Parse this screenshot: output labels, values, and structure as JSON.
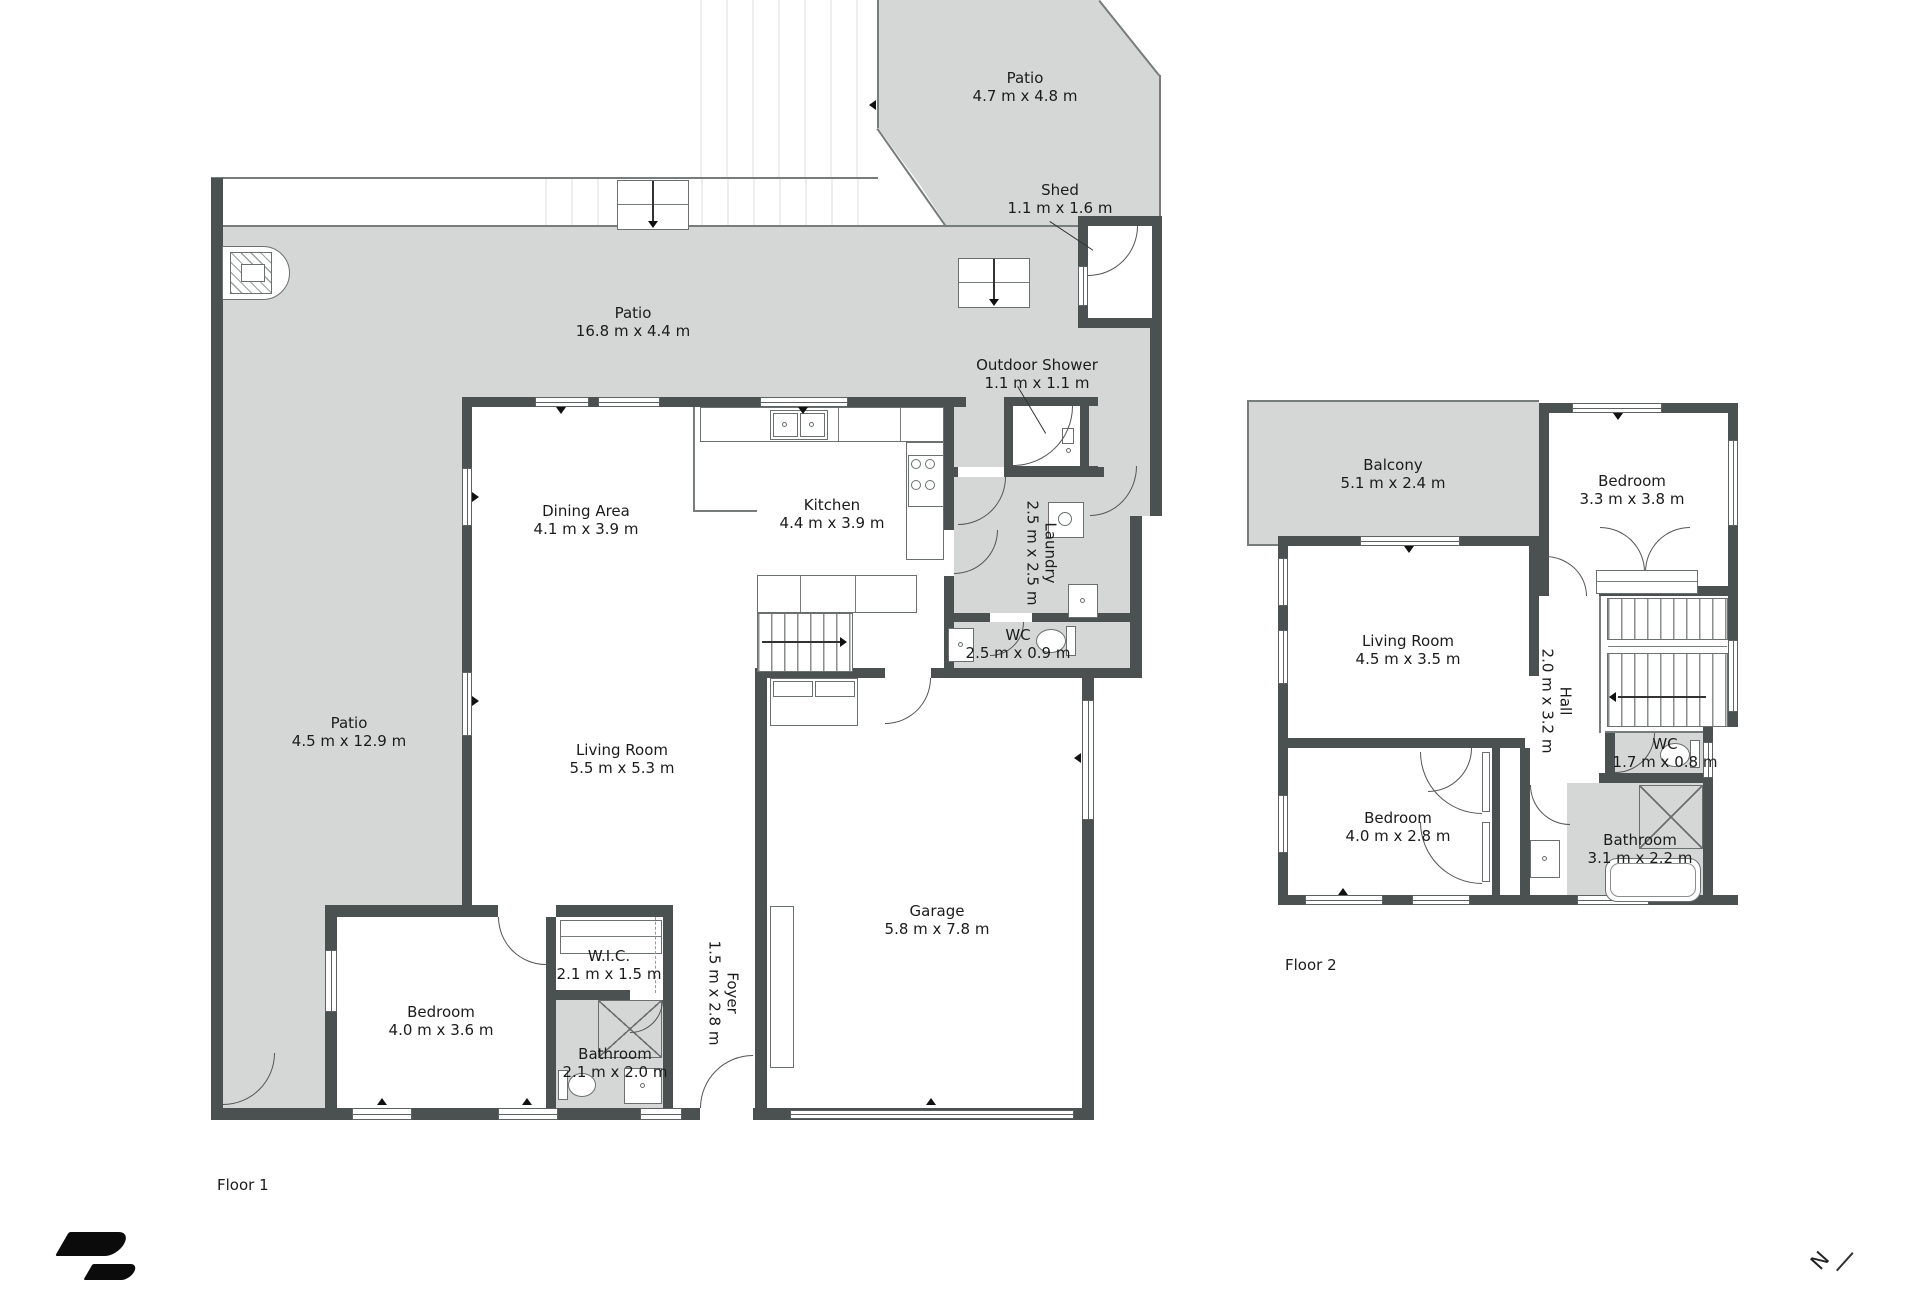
{
  "floors": {
    "floor1": {
      "label": "Floor 1",
      "rooms": {
        "patio_top": {
          "name": "Patio",
          "dims": "4.7 m x 4.8 m"
        },
        "shed": {
          "name": "Shed",
          "dims": "1.1 m x 1.6 m"
        },
        "patio_main": {
          "name": "Patio",
          "dims": "16.8 m x 4.4 m"
        },
        "outdoor_shower": {
          "name": "Outdoor Shower",
          "dims": "1.1 m x 1.1 m"
        },
        "dining": {
          "name": "Dining Area",
          "dims": "4.1 m x 3.9 m"
        },
        "kitchen": {
          "name": "Kitchen",
          "dims": "4.4 m x 3.9 m"
        },
        "laundry": {
          "name": "Laundry",
          "dims": "2.5 m x 2.5 m"
        },
        "wc": {
          "name": "WC",
          "dims": "2.5 m x 0.9 m"
        },
        "patio_left": {
          "name": "Patio",
          "dims": "4.5 m x 12.9 m"
        },
        "living": {
          "name": "Living Room",
          "dims": "5.5 m x 5.3 m"
        },
        "garage": {
          "name": "Garage",
          "dims": "5.8 m x 7.8 m"
        },
        "wic": {
          "name": "W.I.C.",
          "dims": "2.1 m x 1.5 m"
        },
        "foyer": {
          "name": "Foyer",
          "dims": "1.5 m x 2.8 m"
        },
        "bedroom": {
          "name": "Bedroom",
          "dims": "4.0 m x 3.6 m"
        },
        "bathroom": {
          "name": "Bathroom",
          "dims": "2.1 m x 2.0 m"
        }
      }
    },
    "floor2": {
      "label": "Floor 2",
      "rooms": {
        "balcony": {
          "name": "Balcony",
          "dims": "5.1 m x 2.4 m"
        },
        "bedroom_top": {
          "name": "Bedroom",
          "dims": "3.3 m x 3.8 m"
        },
        "living": {
          "name": "Living Room",
          "dims": "4.5 m x 3.5 m"
        },
        "hall": {
          "name": "Hall",
          "dims": "2.0 m x 3.2 m"
        },
        "wc": {
          "name": "WC",
          "dims": "1.7 m x 0.8 m"
        },
        "bedroom_bottom": {
          "name": "Bedroom",
          "dims": "4.0 m x 2.8 m"
        },
        "bathroom": {
          "name": "Bathroom",
          "dims": "3.1 m x 2.2 m"
        }
      }
    }
  },
  "compass": {
    "north_label": "N"
  },
  "colors": {
    "wall": "#4b5151",
    "area_gray": "#d5d7d7",
    "line": "#777c7c",
    "text": "#1b1b1b"
  }
}
